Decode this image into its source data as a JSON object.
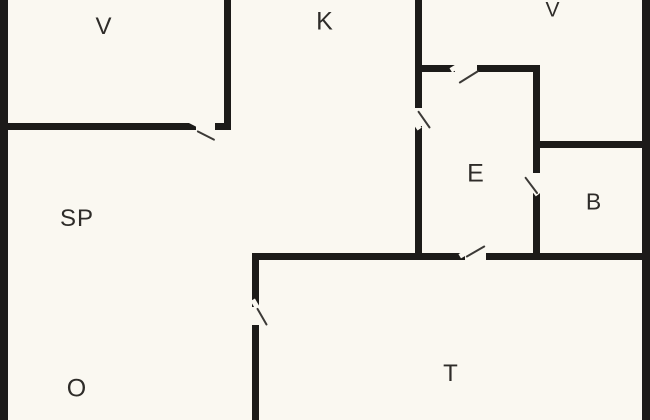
{
  "meta": {
    "type": "floor-plan",
    "canvas_width": 650,
    "canvas_height": 420
  },
  "colors": {
    "background": "#faf8f1",
    "wall": "#1c1b19",
    "door_line": "#3c3a37",
    "label_text": "#2e2c29"
  },
  "rooms": [
    {
      "id": "v-top-left",
      "label": "V",
      "cx": 104,
      "cy": 27,
      "font": 24
    },
    {
      "id": "k-top-mid",
      "label": "K",
      "cx": 325,
      "cy": 22,
      "font": 25
    },
    {
      "id": "v-top-right",
      "label": "V",
      "cx": 553,
      "cy": 10,
      "font": 21
    },
    {
      "id": "sp-left",
      "label": "SP",
      "cx": 77,
      "cy": 219,
      "font": 24
    },
    {
      "id": "e-center",
      "label": "E",
      "cx": 476,
      "cy": 174,
      "font": 25
    },
    {
      "id": "b-right",
      "label": "B",
      "cx": 594,
      "cy": 202,
      "font": 23
    },
    {
      "id": "o-bottom",
      "label": "O",
      "cx": 77,
      "cy": 389,
      "font": 25
    },
    {
      "id": "t-bottom",
      "label": "T",
      "cx": 451,
      "cy": 374,
      "font": 24
    }
  ],
  "walls": [
    {
      "id": "outer-left",
      "x": 0,
      "y": 0,
      "w": 8,
      "h": 420
    },
    {
      "id": "outer-right",
      "x": 642,
      "y": 0,
      "w": 8,
      "h": 420
    },
    {
      "id": "v-top-left-east",
      "x": 224,
      "y": 0,
      "w": 7,
      "h": 130
    },
    {
      "id": "v-top-left-south-a",
      "x": 0,
      "y": 123,
      "w": 196,
      "h": 7
    },
    {
      "id": "v-top-left-south-b",
      "x": 215,
      "y": 123,
      "w": 16,
      "h": 7
    },
    {
      "id": "center-divider-north",
      "x": 415,
      "y": 0,
      "w": 7,
      "h": 108
    },
    {
      "id": "center-divider-south",
      "x": 415,
      "y": 126,
      "w": 7,
      "h": 134
    },
    {
      "id": "e-north-a",
      "x": 415,
      "y": 65,
      "w": 40,
      "h": 7
    },
    {
      "id": "e-north-b",
      "x": 477,
      "y": 65,
      "w": 63,
      "h": 7
    },
    {
      "id": "e-east-north",
      "x": 533,
      "y": 65,
      "w": 7,
      "h": 108
    },
    {
      "id": "e-east-south",
      "x": 533,
      "y": 193,
      "w": 7,
      "h": 67
    },
    {
      "id": "b-north",
      "x": 533,
      "y": 141,
      "w": 117,
      "h": 7
    },
    {
      "id": "t-north-a",
      "x": 252,
      "y": 253,
      "w": 213,
      "h": 7
    },
    {
      "id": "t-north-b",
      "x": 486,
      "y": 253,
      "w": 164,
      "h": 7
    },
    {
      "id": "t-west-north",
      "x": 252,
      "y": 253,
      "w": 7,
      "h": 54
    },
    {
      "id": "t-west-south",
      "x": 252,
      "y": 325,
      "w": 7,
      "h": 95
    }
  ],
  "doors": [
    {
      "id": "door-v-top-left",
      "hx": 197,
      "hy": 130,
      "len": 20,
      "angle": 27
    },
    {
      "id": "door-center",
      "hx": 418,
      "hy": 110,
      "len": 21,
      "angle": 55
    },
    {
      "id": "door-e-north",
      "hx": 459,
      "hy": 82,
      "len": 23,
      "angle": -32
    },
    {
      "id": "door-b",
      "hx": 525,
      "hy": 176,
      "len": 21,
      "angle": 53
    },
    {
      "id": "door-t-north",
      "hx": 466,
      "hy": 256,
      "len": 22,
      "angle": -30
    },
    {
      "id": "door-t-west",
      "hx": 257,
      "hy": 307,
      "len": 20,
      "angle": 60
    }
  ],
  "notches": [
    {
      "id": "jamb-v-top-left",
      "x": 188,
      "y": 120,
      "w": 11,
      "h": 5,
      "angle": 27
    },
    {
      "id": "jamb-center",
      "x": 411,
      "y": 122,
      "w": 11,
      "h": 5,
      "angle": 55
    },
    {
      "id": "jamb-e-north",
      "x": 450,
      "y": 65,
      "w": 11,
      "h": 5,
      "angle": -32
    },
    {
      "id": "jamb-b",
      "x": 529,
      "y": 188,
      "w": 11,
      "h": 5,
      "angle": 53
    },
    {
      "id": "jamb-t-north",
      "x": 459,
      "y": 251,
      "w": 11,
      "h": 5,
      "angle": -30
    },
    {
      "id": "jamb-t-west",
      "x": 250,
      "y": 302,
      "w": 11,
      "h": 5,
      "angle": 60
    }
  ]
}
